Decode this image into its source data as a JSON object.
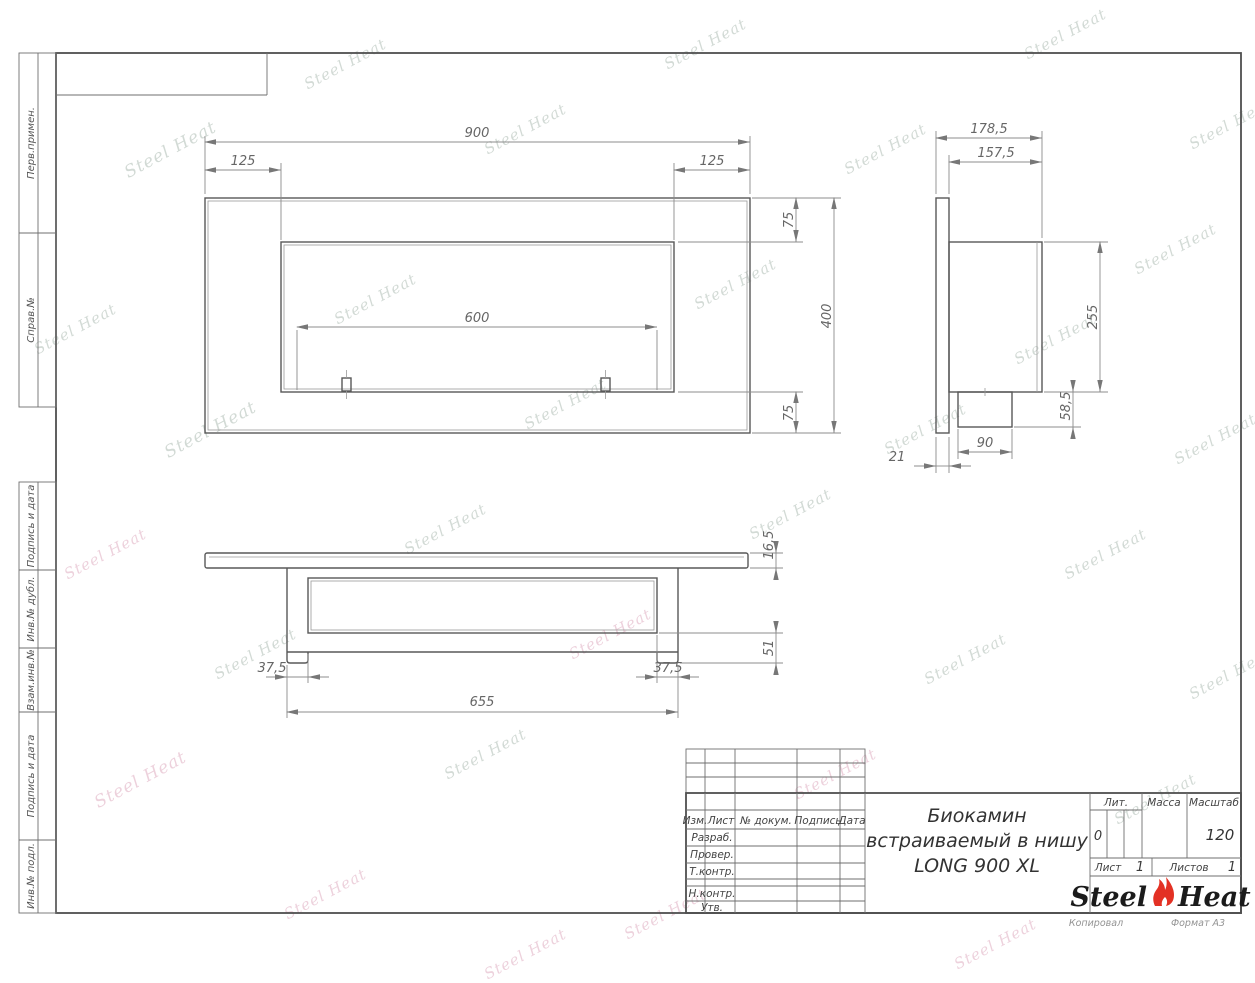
{
  "watermark": {
    "text": "Steel Heat"
  },
  "margin_labels": {
    "perv_primen": "Перв.примен.",
    "sprav_no": "Справ.№",
    "podpis_data_1": "Подпись и дата",
    "inv_dubl": "Инв.№ дубл.",
    "vzam_inv": "Взам.инв.№",
    "podpis_data_2": "Подпись и дата",
    "inv_podl": "Инв.№ подл."
  },
  "views": {
    "front": {
      "width": "900",
      "inset_left": "125",
      "inset_right": "125",
      "burner": "600",
      "top": "75",
      "bottom": "75",
      "height": "400"
    },
    "side": {
      "depth_total": "178,5",
      "depth_body": "157,5",
      "body_height": "255",
      "foot_height": "58,5",
      "foot_width": "90",
      "panel_thickness": "21"
    },
    "bottom": {
      "panel_thickness": "16,5",
      "foot_drop": "51",
      "inset_left": "37,5",
      "inset_right": "37,5",
      "width": "655"
    }
  },
  "title_block": {
    "col_izm": "Изм.",
    "col_list": "Лист",
    "col_doc": "№ докум.",
    "col_sign": "Подпись",
    "col_date": "Дата",
    "row_razrab": "Разраб.",
    "row_prover": "Провер.",
    "row_tkontr": "Т.контр.",
    "row_nkontr": "Н.контр.",
    "row_utv": "Утв.",
    "title_line1": "Биокамин",
    "title_line2": "встраиваемый в нишу",
    "title_line3": "LONG 900 XL",
    "lit_label": "Лит.",
    "lit_value": "0",
    "mass_label": "Масса",
    "scale_label": "Масштаб",
    "scale_value": "120",
    "sheet_label": "Лист",
    "sheet_value": "1",
    "sheets_label": "Листов",
    "sheets_value": "1",
    "kopiroval": "Копировал",
    "format": "Формат А3"
  },
  "logo": {
    "steel": "Steel",
    "heat": "Heat",
    "flame_color": "#e33124"
  }
}
